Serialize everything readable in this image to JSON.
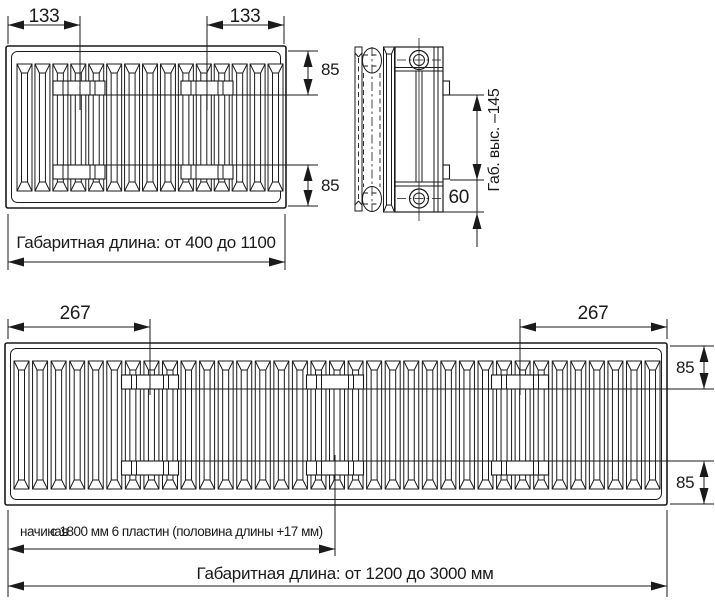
{
  "top_front_view": {
    "dim_left": "133",
    "dim_right": "133",
    "dim_height_top": "85",
    "dim_height_bottom": "85",
    "length_caption": "Габаритная длина: от 400 до 1100"
  },
  "side_view": {
    "height_caption": "Габ. выс. –145",
    "dim_bracket_offset": "60"
  },
  "bottom_front_view": {
    "dim_left": "267",
    "dim_right": "267",
    "dim_height_top": "85",
    "dim_height_bottom": "85",
    "plates_caption_word": "начиная",
    "plates_caption": "с 1800 мм 6 пластин (половина длины +17 мм)",
    "length_caption": "Габаритная длина: от 1200 до 3000 мм"
  },
  "colors": {
    "line": "#1a1a1a",
    "background": "#ffffff"
  }
}
